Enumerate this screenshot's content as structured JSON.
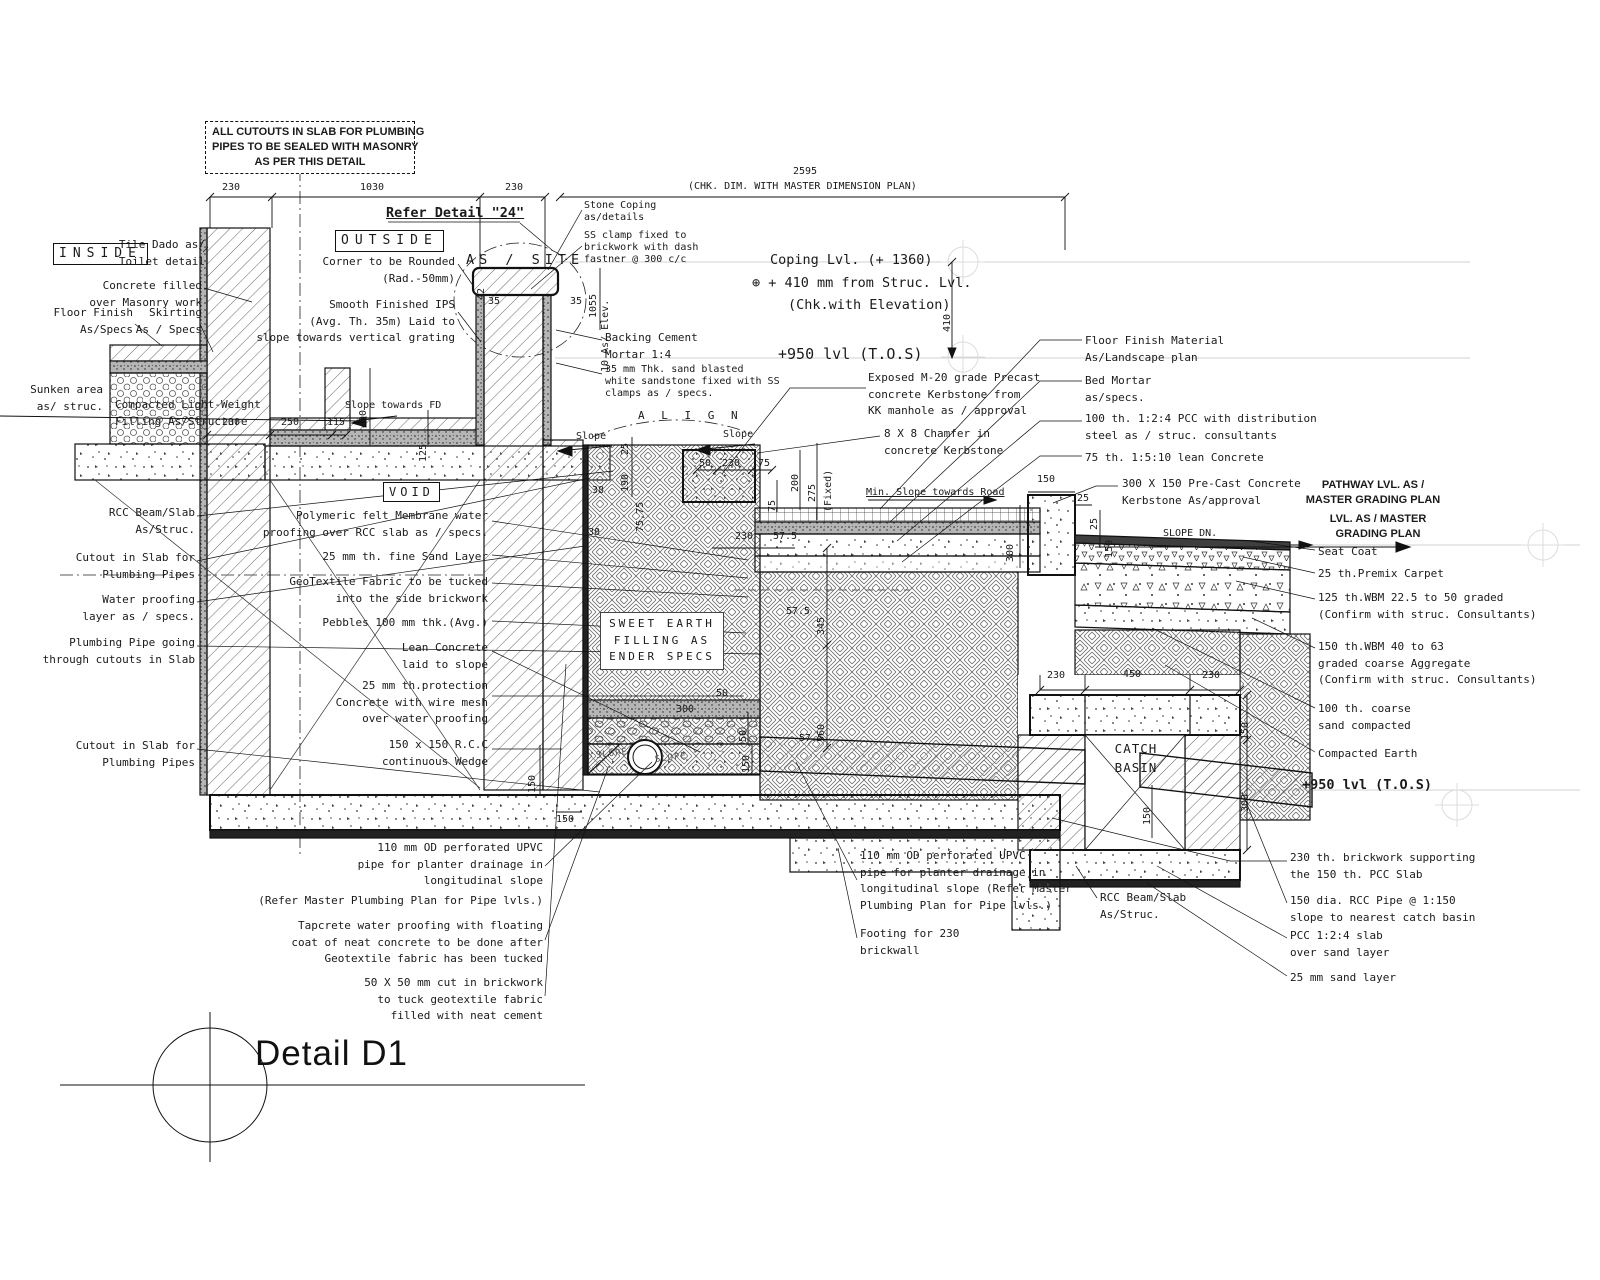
{
  "title": {
    "text": "Detail D1"
  },
  "top": {
    "note": "ALL CUTOUTS IN SLAB FOR PLUMBING\nPIPES TO BE SEALED WITH MASONRY\nAS PER THIS DETAIL",
    "refer_detail": "Refer Detail \"24\"",
    "dim_2595": "2595",
    "chk_note": "(CHK. DIM. WITH MASTER DIMENSION PLAN)"
  },
  "coping": {
    "stone_coping": "Stone Coping\nas/details",
    "ss_clamp": "SS clamp fixed to\nbrickwork with dash\nfastner @ 300 c/c",
    "backing": "Backing Cement\nMortar 1:4",
    "sandstone": "35 mm Thk. sand blasted\nwhite sandstone fixed with SS\nclamps as / specs.",
    "as_site": "AS / SITE",
    "coping_lvl": "Coping Lvl. (+ 1360)",
    "struc_lvl": "⊕ + 410 mm from Struc. Lvl.",
    "chk_elev": "(Chk.with Elevation)",
    "tos": "+950 lvl (T.O.S)"
  },
  "left": {
    "inside": "INSIDE",
    "tile_dado": "Tile Dado as/\nToilet detail",
    "concrete_filled": "Concrete filled\nover Masonry work",
    "floor_finish": "Floor Finish\nAs/Specs",
    "skirting": "Skirting\nAs / Specs",
    "sunken": "Sunken area\nas/ struc.",
    "compacted": "Compacted Light-Weight\nFilling As/Structure",
    "rcc_beam": "RCC Beam/Slab\nAs/Struc.",
    "cutout1": "Cutout in Slab for\nPlumbing Pipes",
    "waterproof": "Water proofing\nlayer as / specs.",
    "plumbing": "Plumbing Pipe going\nthrough cutouts in Slab",
    "cutout2": "Cutout in Slab for\nPlumbing Pipes"
  },
  "center": {
    "outside": "OUTSIDE",
    "corner": "Corner to be Rounded\n(Rad.-50mm)",
    "ips": "Smooth Finished IPS\n(Avg. Th. 35m) Laid to\nslope towards vertical grating",
    "void": "VOID",
    "polymeric": "Polymeric felt Membrane water\nproofing over RCC slab as / specs.",
    "sand": "25 mm th. fine Sand Layer",
    "geotextile": "GeoTextile Fabric to be tucked\ninto the side brickwork",
    "pebbles": "Pebbles 100 mm thk.(Avg.)",
    "lean": "Lean Concrete\nlaid to slope",
    "protection": "25 mm th.protection\nConcrete with wire mesh\nover water proofing",
    "wedge": "150 x 150 R.C.C\ncontinuous Wedge",
    "sweet_earth": "SWEET EARTH\nFILLING AS\nENDER SPECS"
  },
  "kerb": {
    "exposed": "Exposed M-20 grade Precast\nconcrete Kerbstone from\nKK manhole as / approval",
    "chamfer": "8 X 8 Chamfer in\nconcrete Kerbstone"
  },
  "right": {
    "floor_finish": "Floor Finish Material\nAs/Landscape plan",
    "bed_mortar": "Bed Mortar\nas/specs.",
    "pcc100": "100 th. 1:2:4 PCC with distribution\nsteel as / struc. consultants",
    "lean75": "75 th. 1:5:10 lean Concrete",
    "precast": "300 X 150 Pre-Cast Concrete\nKerbstone As/approval",
    "pathway_lvl": "PATHWAY LVL. AS /\nMASTER GRADING PLAN",
    "lvl_master": "LVL. AS / MASTER\nGRADING PLAN",
    "seat_coat": "Seat Coat",
    "premix": "25 th.Premix Carpet",
    "wbm125": "125 th.WBM 22.5 to 50 graded\n(Confirm with struc. Consultants)",
    "wbm150": "150 th.WBM 40 to 63\ngraded coarse Aggregate\n(Confirm with struc. Consultants)",
    "sand100": "100 th. coarse\nsand compacted",
    "compacted_earth": "Compacted Earth",
    "tos": "+950 lvl (T.O.S)"
  },
  "catch_basin": {
    "label": "CATCH\nBASIN",
    "rcc_beam": "RCC Beam/Slab\nAs/Struc."
  },
  "bottom_left": {
    "upvc": "110 mm OD perforated UPVC\npipe for planter drainage in\nlongitudinal slope",
    "upvc_refer": "(Refer Master Plumbing Plan for Pipe lvls.)",
    "tapcrete": "Tapcrete water proofing with floating\ncoat of neat concrete to be done after\nGeotextile fabric has been tucked",
    "cut": "50 X 50 mm cut in brickwork\nto tuck geotextile fabric\nfilled with neat cement"
  },
  "bottom_center": {
    "upvc": "110 mm OD perforated UPVC\npipe for planter drainage in\nlongitudinal slope (Refer Master\nPlumbing Plan for Pipe lvls.)",
    "footing": "Footing for 230\nbrickwall"
  },
  "bottom_right": {
    "brickwork": "230 th. brickwork supporting\nthe 150 th. PCC Slab",
    "rcc_pipe": "150 dia. RCC Pipe @ 1:150\nslope to nearest catch basin",
    "pcc_slab": "PCC 1:2:4 slab\nover sand layer",
    "sand": "25 mm sand layer"
  },
  "marks": {
    "align": "A L I G N",
    "slope": "Slope",
    "slope_fd": "Slope towards FD",
    "slope_cap": "SLOPE",
    "slope_dn": "SLOPE DN.",
    "min_slope": "Min. Slope towards Road"
  },
  "dims": {
    "w230a": "230",
    "w1030": "1030",
    "w230b": "230",
    "h410": "410",
    "w230w": "230",
    "w250": "250",
    "w115": "115",
    "h400": "400",
    "h125": "125",
    "h42": "42",
    "w35a": "35",
    "w35b": "35",
    "h1055": "1055",
    "as_elev": "10 As/ Elev.",
    "h25": "25",
    "h190": "190",
    "w50a": "50",
    "w230c": "230",
    "w75a": "75",
    "h200": "200",
    "h275": "275",
    "fixed": "(Fixed)",
    "h75b": "75",
    "w38a": "38",
    "w38b": "38",
    "h7575": "75,75",
    "w230d": "230",
    "w57a": "57.5",
    "h345": "345",
    "w57b": "57.5",
    "h560": "560",
    "w57c": "57.5",
    "w300p": "300",
    "w50b": "50",
    "h50c": "50",
    "h150p": "150",
    "h150w": "150",
    "w150s": "150",
    "w150k": "150",
    "w25k": "25",
    "h25k": "25",
    "h150kv": "150",
    "h300kv": "300",
    "w230e": "230",
    "w450": "450",
    "w230f": "230",
    "h150r": "150",
    "h300r": "300",
    "h150pipe": "150"
  }
}
